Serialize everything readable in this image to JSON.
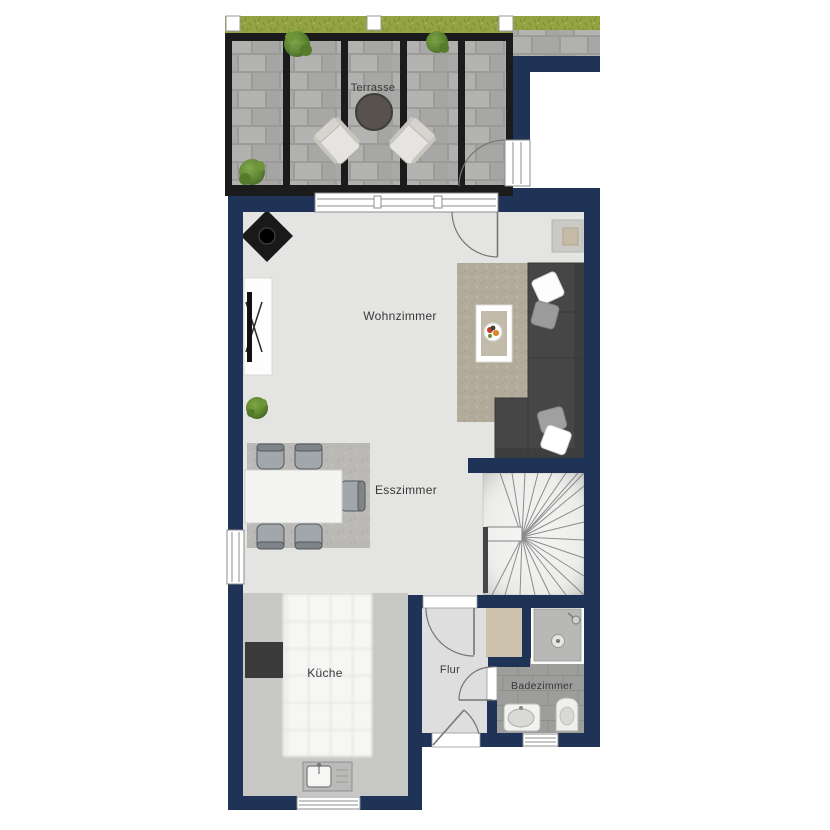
{
  "floorplan": {
    "rooms": {
      "terrasse": {
        "label": "Terrasse"
      },
      "wohnzimmer": {
        "label": "Wohnzimmer"
      },
      "esszimmer": {
        "label": "Esszimmer"
      },
      "kueche": {
        "label": "Küche"
      },
      "flur": {
        "label": "Flur"
      },
      "badezimmer": {
        "label": "Badezimmer"
      }
    },
    "colors": {
      "wall": "#1e3355",
      "terrace_frame": "#1b1b1b",
      "floor_main": "#e4e4e2",
      "floor_kitchen": "#c7c7c5",
      "floor_flur": "#dedede",
      "grass": "#95a442",
      "sofa": "#464646",
      "label_text": "#383838"
    }
  }
}
